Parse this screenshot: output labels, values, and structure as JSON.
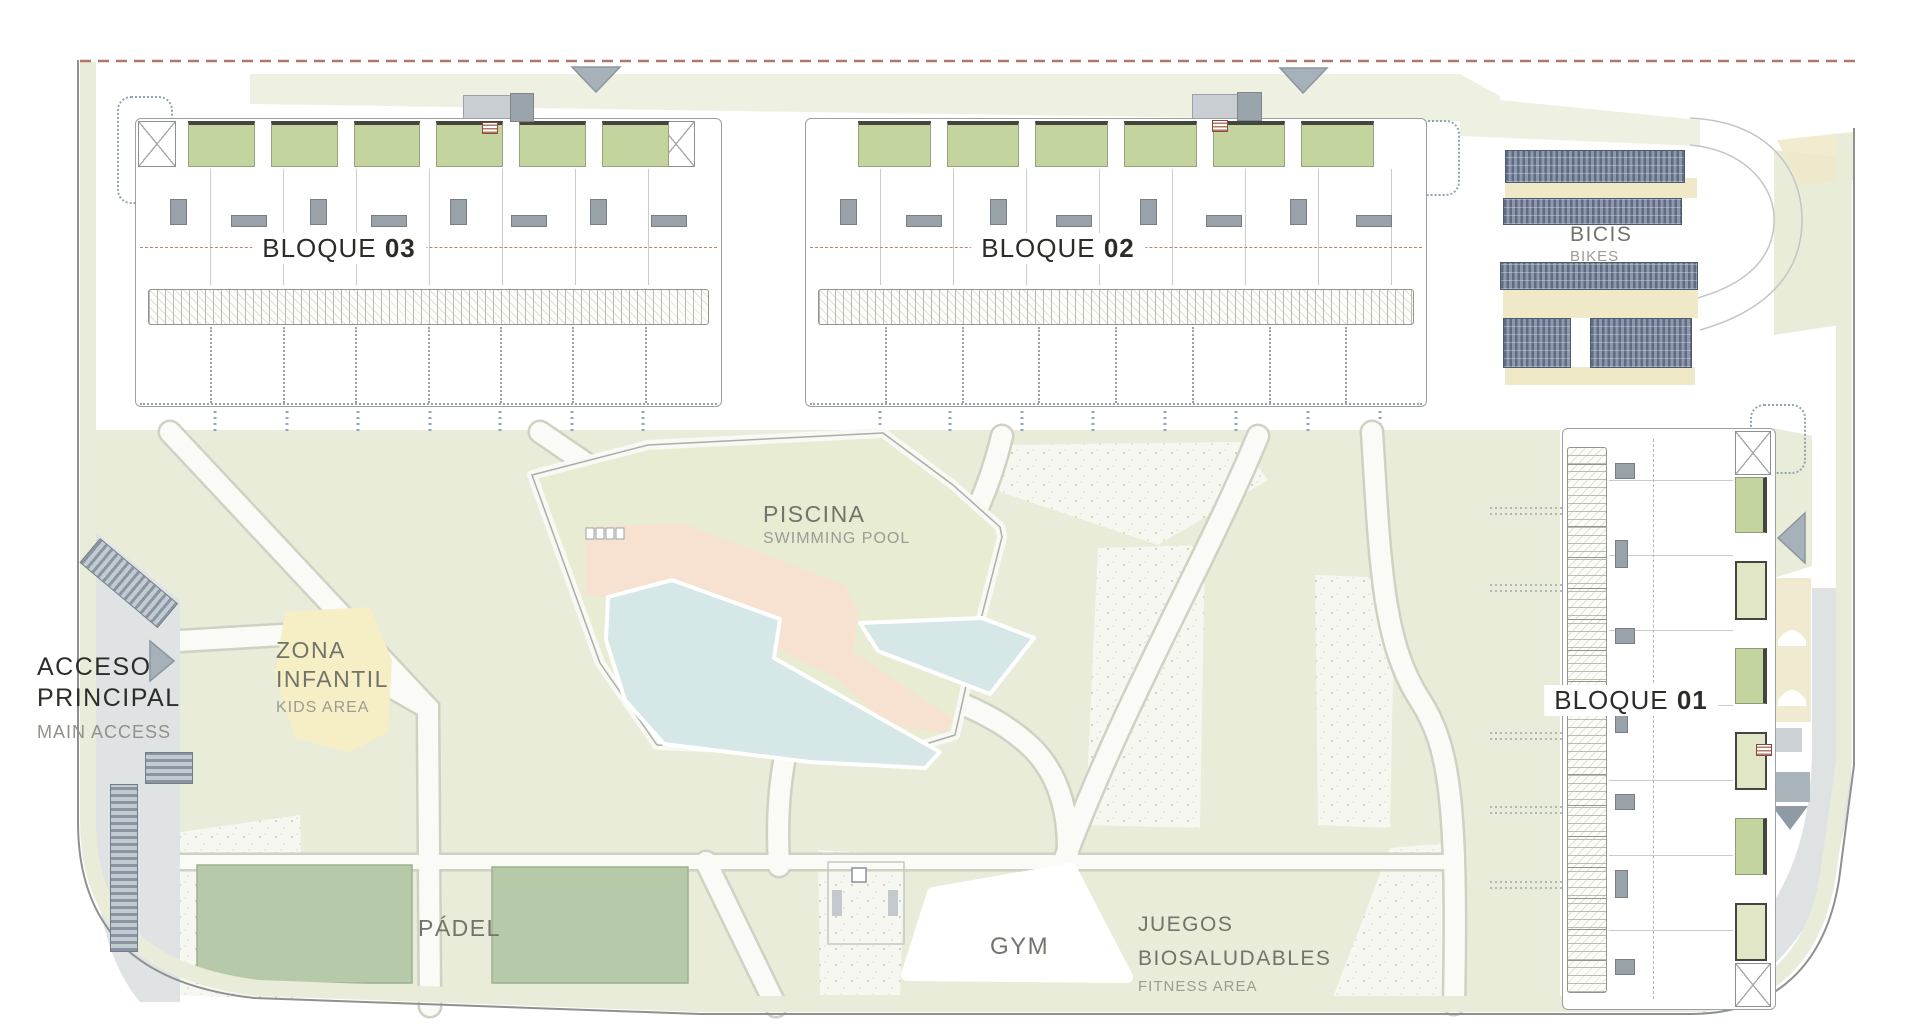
{
  "plan_title": "Residential masterplan site drawing",
  "labels": {
    "bloque03": {
      "name": "BLOQUE",
      "num": "03"
    },
    "bloque02": {
      "name": "BLOQUE",
      "num": "02"
    },
    "bloque01": {
      "name": "BLOQUE",
      "num": "01"
    },
    "bicis": {
      "es": "BICIS",
      "en": "BIKES"
    },
    "piscina": {
      "es": "PISCINA",
      "en": "SWIMMING POOL"
    },
    "zona_infantil": {
      "es_line1": "ZONA",
      "es_line2": "INFANTIL",
      "en": "KIDS AREA"
    },
    "acceso": {
      "es_line1": "ACCESO",
      "es_line2": "PRINCIPAL",
      "en": "MAIN ACCESS"
    },
    "padel": {
      "es": "PÁDEL"
    },
    "gym": {
      "es": "GYM"
    },
    "juegos": {
      "es_line1": "JUEGOS",
      "es_line2": "BIOSALUDABLES",
      "en": "FITNESS AREA"
    }
  },
  "blocks": {
    "b03": {
      "patios": 6,
      "furniture": 8,
      "plots": 8
    },
    "b02": {
      "patios": 6,
      "furniture": 8,
      "plots": 8
    },
    "b01": {
      "patios": 6,
      "furniture": 7
    }
  },
  "icons": {
    "direction_markers": 4,
    "stair_boxes": 4
  },
  "colors": {
    "lawn": "#e9ecd8",
    "lawn_pale": "#eef1e1",
    "pool_water": "#d6e7e8",
    "pool_deck": "#f7e2d2",
    "kids_area": "#f6efc6",
    "padel_court": "#b6caa9",
    "bike_rack": "#5e6b83",
    "road": "#e0e3e4",
    "boundary_dash": "#b5766a",
    "patio_green": "#c3d49f",
    "text_dark": "#2c2c29",
    "text_gray": "#70746a"
  }
}
